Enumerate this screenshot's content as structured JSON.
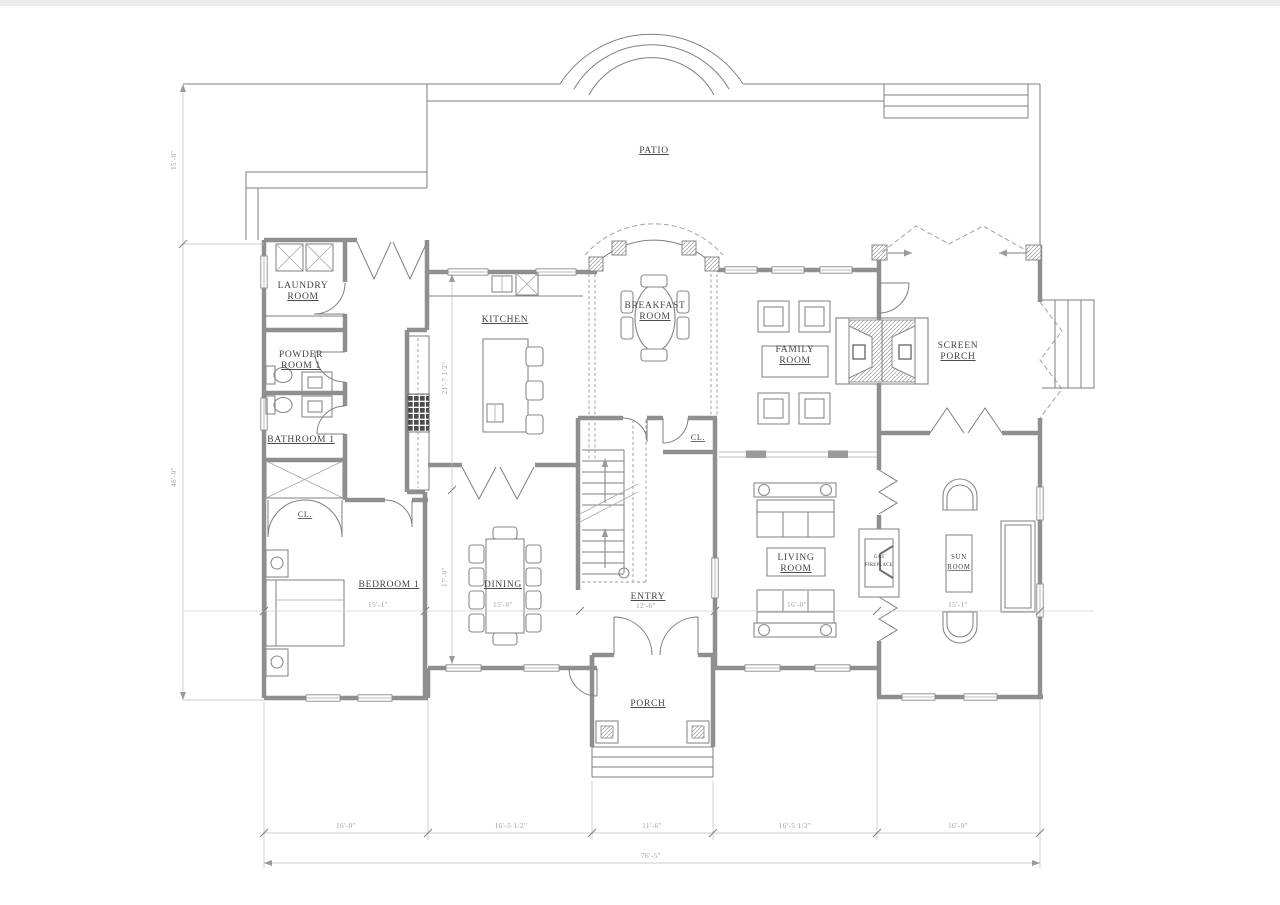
{
  "plan": {
    "rooms": {
      "patio": "PATIO",
      "laundry": [
        "LAUNDRY",
        "ROOM"
      ],
      "kitchen": "KITCHEN",
      "breakfast": [
        "BREAKFAST",
        "ROOM"
      ],
      "family": [
        "FAMILY",
        "ROOM"
      ],
      "screen_porch": [
        "SCREEN",
        "PORCH"
      ],
      "powder": [
        "POWDER",
        "ROOM 1"
      ],
      "bathroom": "BATHROOM 1",
      "closet_entry": "CL.",
      "closet_bedroom": "CL.",
      "bedroom": "BEDROOM 1",
      "dining": "DINING",
      "entry": "ENTRY",
      "living": [
        "LIVING",
        "ROOM"
      ],
      "gas_fireplace": [
        "GAS",
        "FIREPLACE"
      ],
      "sun_room": [
        "SUN",
        "ROOM"
      ],
      "porch": "PORCH"
    },
    "dimensions": {
      "left_upper": "15'-0\"",
      "left_main": "46'-0\"",
      "kitchen_depth": "21'-7 1/2\"",
      "dining_depth": "17'-0\"",
      "bedroom_width": "15'-1\"",
      "dining_width": "15'-0\"",
      "entry_width": "12'-6\"",
      "living_width": "16'-0\"",
      "sun_width": "15'-1\"",
      "bottom": [
        "16'-0\"",
        "16'-5 1/2\"",
        "11'-6\"",
        "16'-5 1/2\"",
        "16'-0\""
      ],
      "overall_width": "76'-5\""
    }
  }
}
